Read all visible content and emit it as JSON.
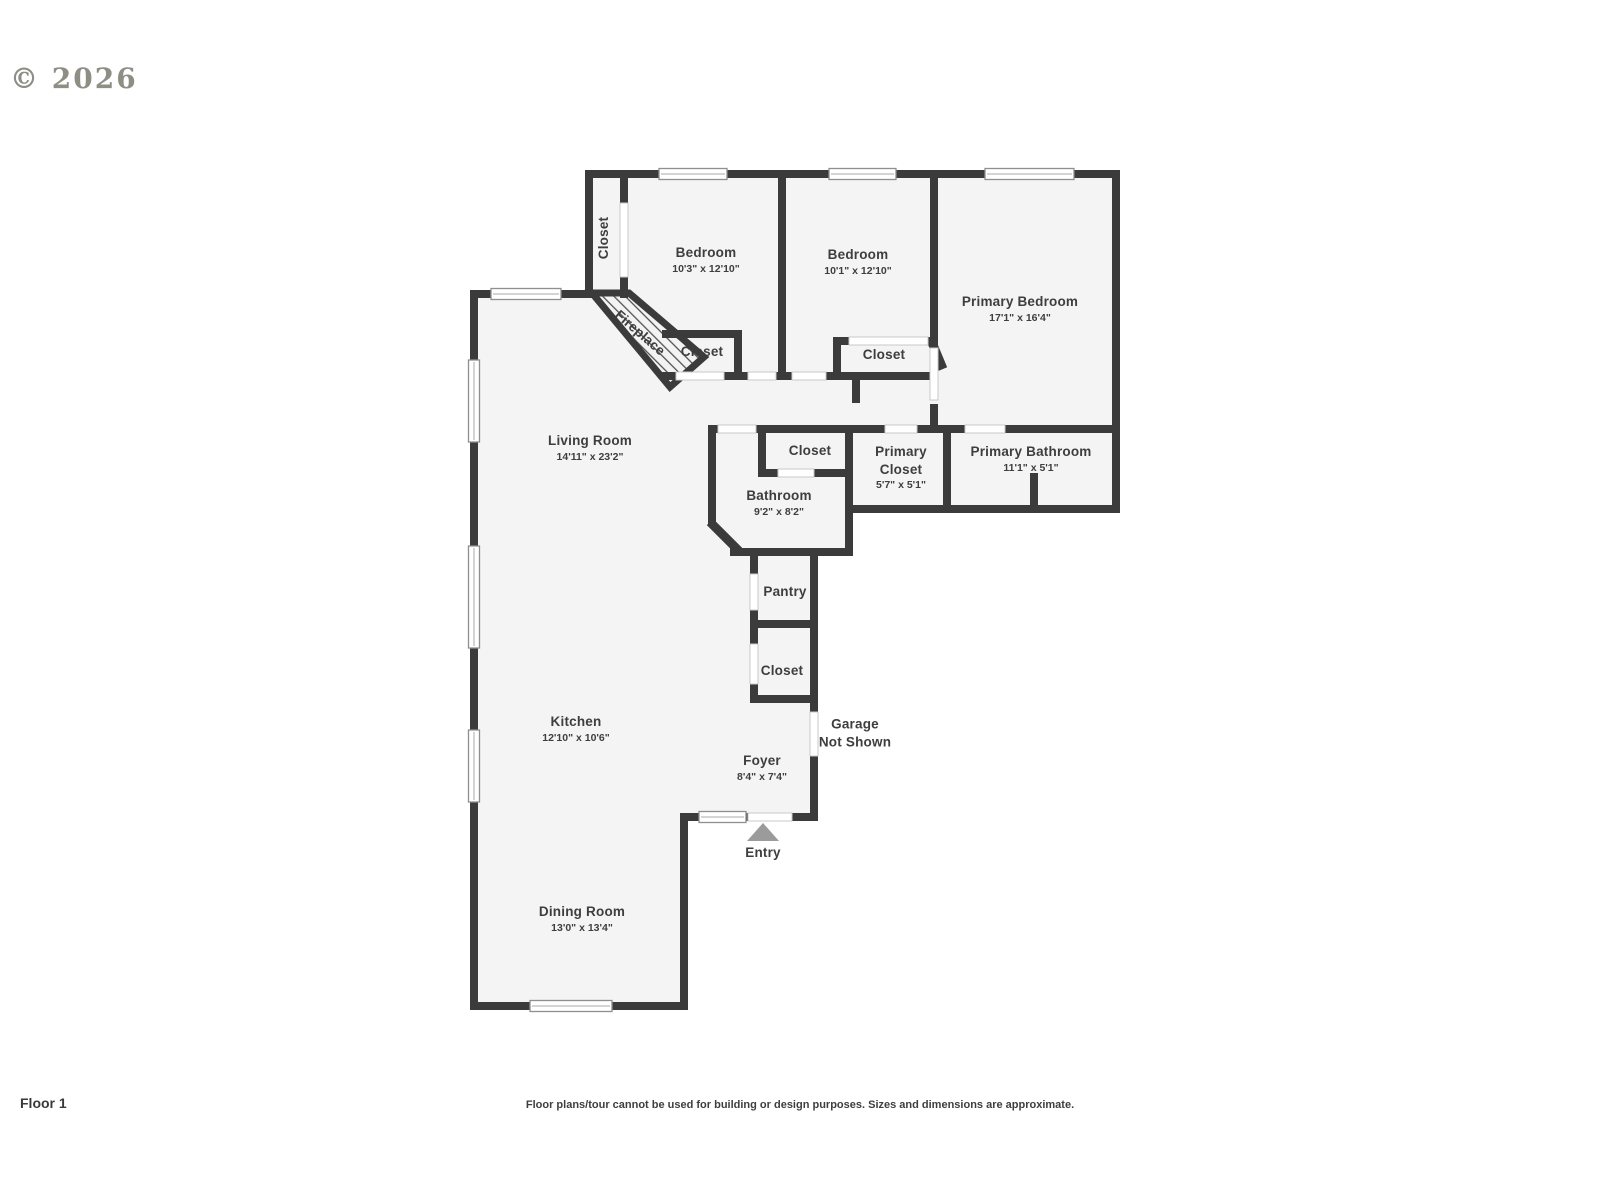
{
  "copyright": "© 2026",
  "floor_label": "Floor 1",
  "disclaimer": "Floor plans/tour cannot be used for building or design purposes. Sizes and dimensions are approximate.",
  "colors": {
    "wall": "#3b3b3b",
    "floor": "#f4f4f4",
    "background": "#ffffff",
    "label_text": "#3e3e3e",
    "entry_arrow": "#9b9b9b"
  },
  "rooms": [
    {
      "id": "closet-top",
      "name": "Closet",
      "dims": ""
    },
    {
      "id": "bedroom-1",
      "name": "Bedroom",
      "dims": "10'3\" x 12'10\""
    },
    {
      "id": "bedroom-2",
      "name": "Bedroom",
      "dims": "10'1\" x 12'10\""
    },
    {
      "id": "primary-bedroom",
      "name": "Primary Bedroom",
      "dims": "17'1\" x 16'4\""
    },
    {
      "id": "fireplace",
      "name": "Fireplace",
      "dims": ""
    },
    {
      "id": "closet-fireplace",
      "name": "Closet",
      "dims": ""
    },
    {
      "id": "closet-bedroom-2",
      "name": "Closet",
      "dims": ""
    },
    {
      "id": "living-room",
      "name": "Living Room",
      "dims": "14'11\" x 23'2\""
    },
    {
      "id": "closet-hall",
      "name": "Closet",
      "dims": ""
    },
    {
      "id": "primary-closet",
      "name": "Primary\nCloset",
      "dims": "5'7\" x 5'1\""
    },
    {
      "id": "primary-bathroom",
      "name": "Primary Bathroom",
      "dims": "11'1\" x 5'1\""
    },
    {
      "id": "bathroom",
      "name": "Bathroom",
      "dims": "9'2\" x 8'2\""
    },
    {
      "id": "pantry",
      "name": "Pantry",
      "dims": ""
    },
    {
      "id": "closet-pantry",
      "name": "Closet",
      "dims": ""
    },
    {
      "id": "kitchen",
      "name": "Kitchen",
      "dims": "12'10\" x 10'6\""
    },
    {
      "id": "garage",
      "name": "Garage\nNot Shown",
      "dims": ""
    },
    {
      "id": "foyer",
      "name": "Foyer",
      "dims": "8'4\" x 7'4\""
    },
    {
      "id": "entry",
      "name": "Entry",
      "dims": ""
    },
    {
      "id": "dining-room",
      "name": "Dining Room",
      "dims": "13'0\" x 13'4\""
    }
  ]
}
